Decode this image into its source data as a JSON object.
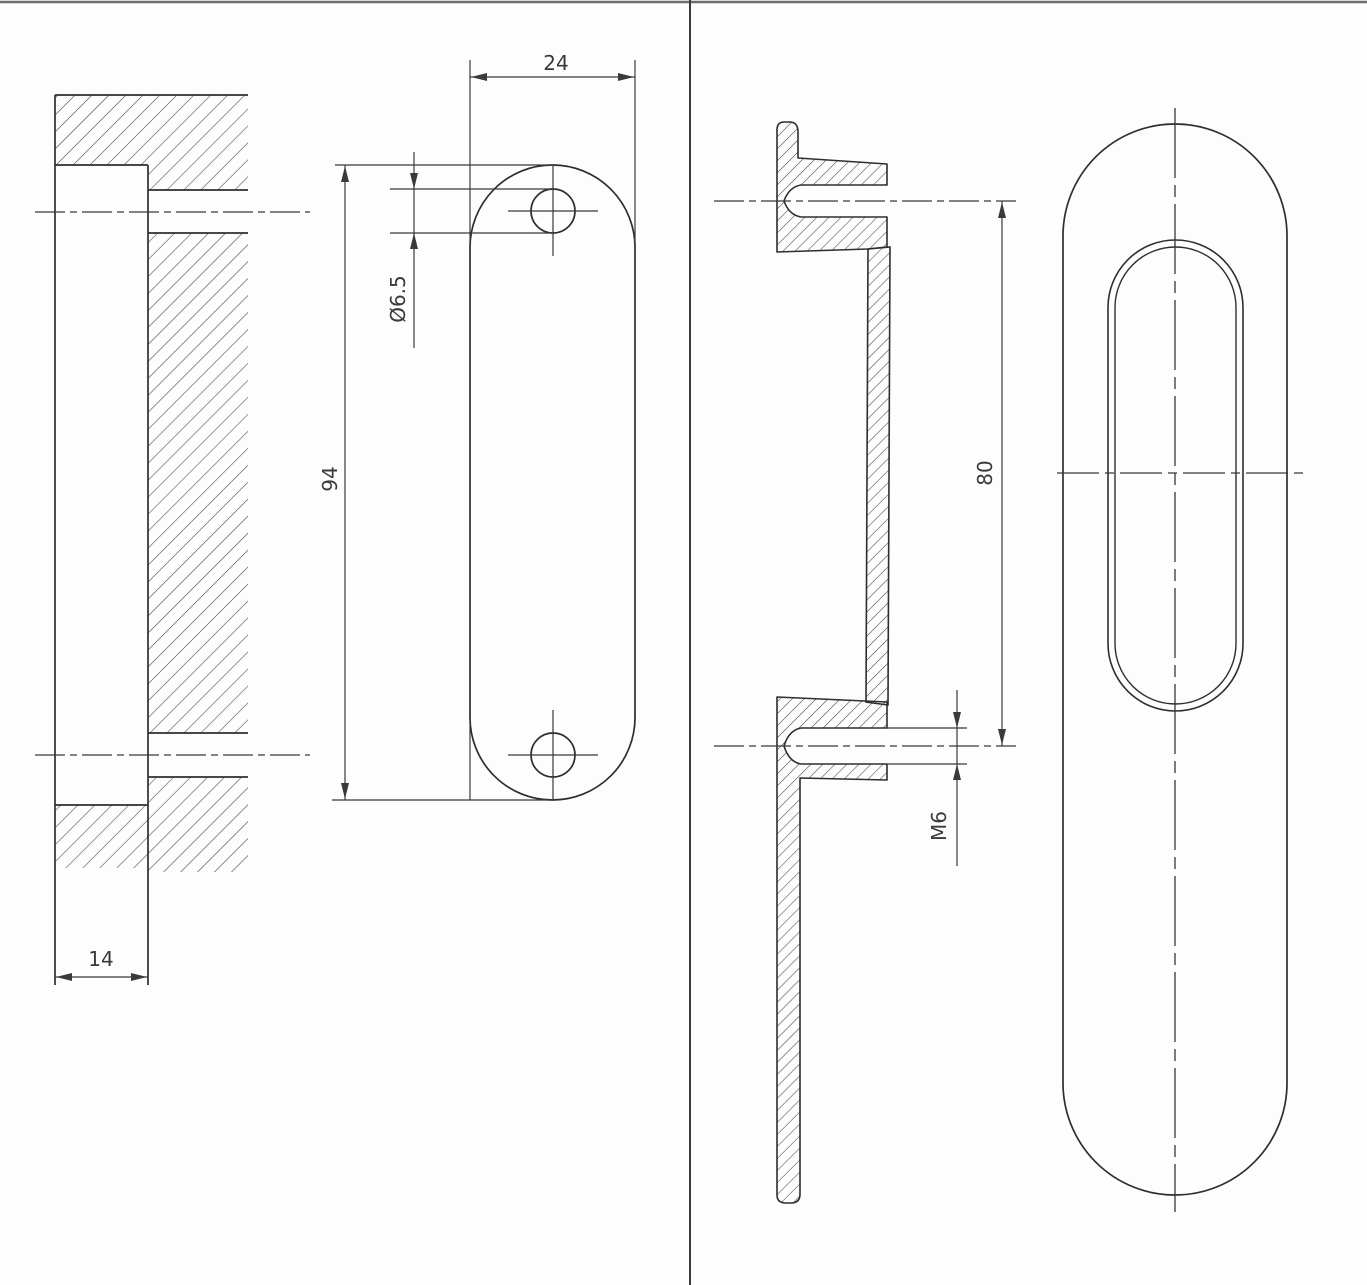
{
  "page": {
    "background": "#fdfdfd",
    "line_color": "#2e2e2e",
    "dim_color": "#3a3a3a"
  },
  "drawing": {
    "type": "technical-drawing",
    "subject": "flush-pull-handle-with-mortise-cutout",
    "views": {
      "mortise_section": "left cutout section with hatching",
      "cutout_face": "stadium cutout face with two holes",
      "handle_section": "handle profile section with threaded bosses",
      "handle_face": "handle face with recessed oval grip"
    },
    "dimensions": {
      "cutout_width": "24",
      "hole_diameter": "Ø6.5",
      "cutout_height": "94",
      "recess_depth": "14",
      "hole_spacing": "80",
      "thread_size": "M6"
    }
  }
}
